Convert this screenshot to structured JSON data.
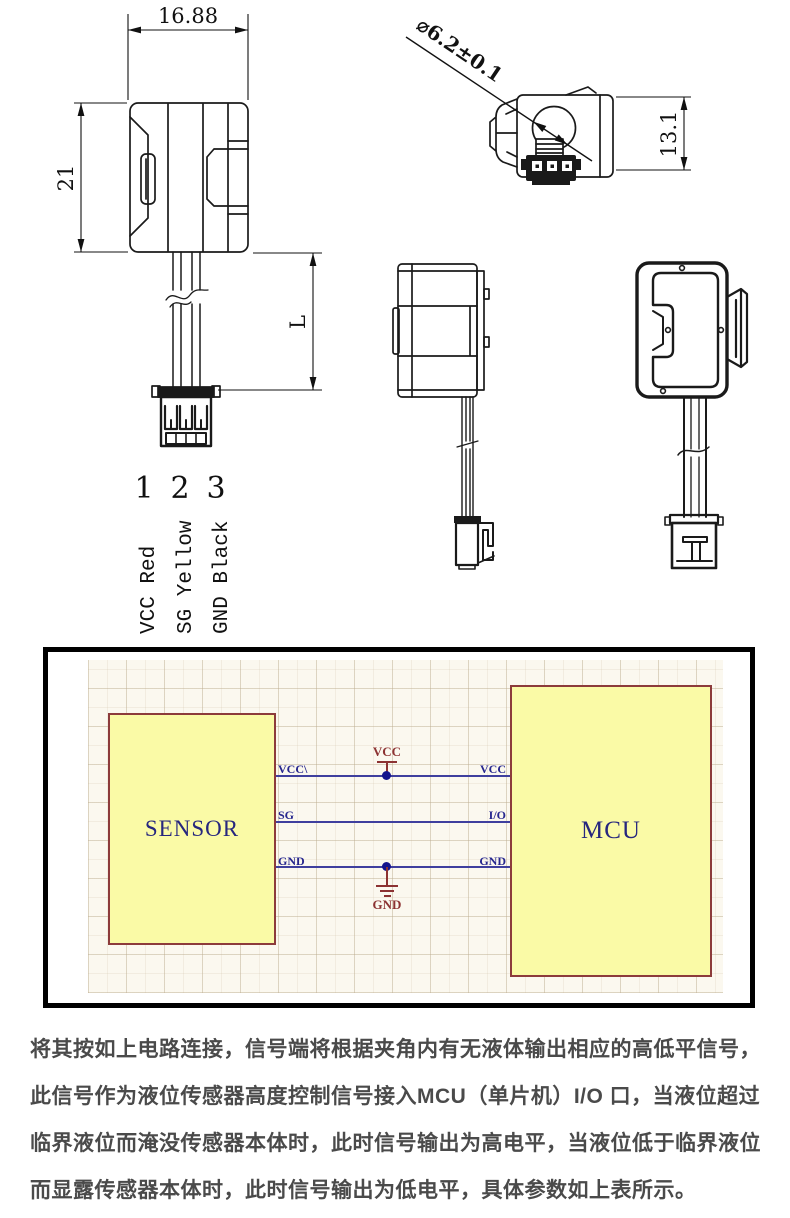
{
  "drawings": {
    "front_view": {
      "width_dim": "16.88",
      "height_dim": "21",
      "lead_dim": "L",
      "pins": [
        {
          "number": "1",
          "label": "VCC Red"
        },
        {
          "number": "2",
          "label": "SG Yellow"
        },
        {
          "number": "3",
          "label": "GND Black"
        }
      ]
    },
    "top_view": {
      "diameter_dim": "⌀6.2±0.1",
      "height_dim": "13.1"
    }
  },
  "schematic": {
    "sensor_label": "SENSOR",
    "mcu_label": "MCU",
    "sensor_pins": [
      "VCC\\",
      "SG",
      "GND"
    ],
    "mcu_pins": [
      "VCC",
      "I/O",
      "GND"
    ],
    "power_net": "VCC",
    "ground_net": "GND",
    "colors": {
      "block_fill": "#FAFAA6",
      "block_border": "#8C3B3B",
      "wire": "#3F3F9E",
      "net_label": "#26268E",
      "power_symbol": "#8C3232",
      "sheet_bg": "#FBF8EF"
    }
  },
  "description": {
    "lines": [
      "将其按如上电路连接，信号端将根据夹角内有无液体输出相应的高低平信号，",
      "此信号作为液位传感器高度控制信号接入MCU（单片机）I/O 口，当液位超过",
      "临界液位而淹没传感器本体时，此时信号输出为高电平，当液位低于临界液位",
      "而显露传感器本体时，此时信号输出为低电平，具体参数如上表所示。"
    ]
  }
}
